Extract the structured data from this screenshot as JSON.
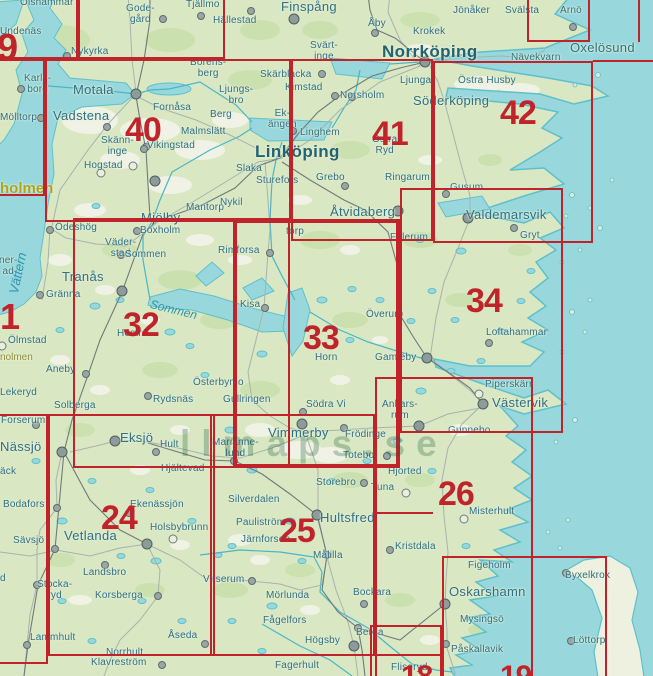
{
  "map_title": "Map sheet index – Östergötland / Småland (sheets 24-26, 32-34, 40-42)",
  "colors": {
    "sea": "#98d8dc",
    "land": "#d9e8c2",
    "sheet_red": "#c1232b",
    "label_teal": "#2f7082",
    "yellow_label": "#b3a314"
  },
  "watermark": {
    "text": "llmaps.se",
    "x": 180,
    "y": 423
  },
  "sheet_numbers": [
    {
      "text": "9",
      "x": -3,
      "y": 29,
      "fs": 38
    },
    {
      "text": "40",
      "x": 125,
      "y": 113
    },
    {
      "text": "41",
      "x": 372,
      "y": 117
    },
    {
      "text": "42",
      "x": 500,
      "y": 96
    },
    {
      "text": "1",
      "x": 0,
      "y": 299,
      "fs": 36
    },
    {
      "text": "32",
      "x": 123,
      "y": 308
    },
    {
      "text": "33",
      "x": 303,
      "y": 321
    },
    {
      "text": "34",
      "x": 466,
      "y": 284
    },
    {
      "text": "24",
      "x": 101,
      "y": 501
    },
    {
      "text": "25",
      "x": 279,
      "y": 514
    },
    {
      "text": "26",
      "x": 438,
      "y": 477
    },
    {
      "text": "18",
      "x": 401,
      "y": 662,
      "fs": 30
    },
    {
      "text": "19",
      "x": 500,
      "y": 662,
      "fs": 30
    }
  ],
  "rects": [
    {
      "x": -30,
      "y": -40,
      "w": 108,
      "h": 99
    },
    {
      "x": 78,
      "y": -40,
      "w": 147,
      "h": 99
    },
    {
      "x": 527,
      "y": -30,
      "w": 63,
      "h": 72
    },
    {
      "x": -60,
      "y": 59,
      "w": 105,
      "h": 137
    },
    {
      "x": 45,
      "y": 59,
      "w": 246,
      "h": 163
    },
    {
      "x": 291,
      "y": 59,
      "w": 142,
      "h": 182
    },
    {
      "x": 433,
      "y": 61,
      "w": 160,
      "h": 182
    },
    {
      "x": 73,
      "y": 218,
      "w": 217,
      "h": 250
    },
    {
      "x": 233,
      "y": 219,
      "w": 167,
      "h": 249,
      "cls": "bold"
    },
    {
      "x": 400,
      "y": 188,
      "w": 163,
      "h": 245
    },
    {
      "x": 375,
      "y": 377,
      "w": 158,
      "h": 320
    },
    {
      "x": 48,
      "y": 414,
      "w": 167,
      "h": 242
    },
    {
      "x": 210,
      "y": 414,
      "w": 165,
      "h": 242
    },
    {
      "x": -60,
      "y": 414,
      "w": 108,
      "h": 250
    },
    {
      "x": 370,
      "y": 625,
      "w": 72,
      "h": 80
    },
    {
      "x": 442,
      "y": 556,
      "w": 165,
      "h": 150
    }
  ],
  "segments": [
    {
      "x": 373,
      "y": 512,
      "w": 60,
      "h": 2
    },
    {
      "x": 375,
      "y": 654,
      "w": 67,
      "h": 2
    },
    {
      "x": 593,
      "y": 60,
      "w": 60,
      "h": 2
    },
    {
      "x": 638,
      "y": 0,
      "w": 2,
      "h": 42
    }
  ],
  "towns": [
    {
      "text": "Olshammar",
      "x": 20,
      "y": -2
    },
    {
      "text": "Undenäs",
      "x": 0,
      "y": 27
    },
    {
      "text": "Gode-\ngård",
      "x": 126,
      "y": 4,
      "cls": "two"
    },
    {
      "text": "Tjällmo",
      "x": 186,
      "y": 0
    },
    {
      "text": "Hällestad",
      "x": 213,
      "y": 16
    },
    {
      "text": "Finspång",
      "x": 281,
      "y": 0,
      "cls": "lg"
    },
    {
      "text": "Jönåker",
      "x": 453,
      "y": 6
    },
    {
      "text": "Svälsta",
      "x": 505,
      "y": 6
    },
    {
      "text": "Arnö",
      "x": 560,
      "y": 6
    },
    {
      "text": "Krokek",
      "x": 413,
      "y": 27
    },
    {
      "text": "Åby",
      "x": 368,
      "y": 19
    },
    {
      "text": "Nykyrka",
      "x": 71,
      "y": 47
    },
    {
      "text": "Norrköping",
      "x": 382,
      "y": 43,
      "cls": "xl"
    },
    {
      "text": "Oxelösund",
      "x": 570,
      "y": 41,
      "cls": "lg"
    },
    {
      "text": "Nävekvarn",
      "x": 511,
      "y": 53
    },
    {
      "text": "Karls-\nborg",
      "x": 24,
      "y": 74,
      "cls": "two"
    },
    {
      "text": "Borens-\nberg",
      "x": 190,
      "y": 58,
      "cls": "two"
    },
    {
      "text": "Svärt-\ninge",
      "x": 310,
      "y": 41,
      "cls": "two"
    },
    {
      "text": "Skärblacka",
      "x": 260,
      "y": 70
    },
    {
      "text": "Kimstad",
      "x": 285,
      "y": 83
    },
    {
      "text": "Norsholm",
      "x": 340,
      "y": 91
    },
    {
      "text": "Ljunga",
      "x": 400,
      "y": 76
    },
    {
      "text": "Östra Husby",
      "x": 458,
      "y": 76
    },
    {
      "text": "Söderköping",
      "x": 413,
      "y": 94,
      "cls": "lg"
    },
    {
      "text": "Mölltorp",
      "x": 0,
      "y": 113
    },
    {
      "text": "Motala",
      "x": 73,
      "y": 83,
      "cls": "lg"
    },
    {
      "text": "Fornåsa",
      "x": 153,
      "y": 103
    },
    {
      "text": "Ljungs-\nbro",
      "x": 219,
      "y": 85,
      "cls": "two"
    },
    {
      "text": "Berg",
      "x": 210,
      "y": 110
    },
    {
      "text": "Ek-\nängen",
      "x": 268,
      "y": 109,
      "cls": "two"
    },
    {
      "text": "Linghem",
      "x": 300,
      "y": 128
    },
    {
      "text": "Malmslätt",
      "x": 181,
      "y": 127
    },
    {
      "text": "Vikingstad",
      "x": 147,
      "y": 141
    },
    {
      "text": "Skänn-\ninge",
      "x": 101,
      "y": 136,
      "cls": "two"
    },
    {
      "text": "Hogstad",
      "x": 84,
      "y": 161
    },
    {
      "text": "Vadstena",
      "x": 53,
      "y": 109,
      "cls": "lg"
    },
    {
      "text": "Linköping",
      "x": 255,
      "y": 143,
      "cls": "xl"
    },
    {
      "text": "Östra\nRyd",
      "x": 372,
      "y": 135,
      "cls": "two"
    },
    {
      "text": "Ringarum",
      "x": 385,
      "y": 173
    },
    {
      "text": "Mjölby",
      "x": 141,
      "y": 211,
      "cls": "lg"
    },
    {
      "text": "Mantorp",
      "x": 186,
      "y": 203
    },
    {
      "text": "Väder-\nstad",
      "x": 105,
      "y": 238,
      "cls": "two"
    },
    {
      "text": "Slaka",
      "x": 236,
      "y": 164
    },
    {
      "text": "Sturefors",
      "x": 256,
      "y": 176
    },
    {
      "text": "Grebo",
      "x": 316,
      "y": 173
    },
    {
      "text": "Nykil",
      "x": 220,
      "y": 198
    },
    {
      "text": "Åtvidaberg",
      "x": 330,
      "y": 205,
      "cls": "lg"
    },
    {
      "text": "Gusum",
      "x": 450,
      "y": 183
    },
    {
      "text": "Valdemarsvik",
      "x": 466,
      "y": 208,
      "cls": "lg"
    },
    {
      "text": "Gryt",
      "x": 520,
      "y": 231
    },
    {
      "text": "Falerum",
      "x": 390,
      "y": 233
    },
    {
      "text": "torp",
      "x": 286,
      "y": 227
    },
    {
      "text": "Ödeshög",
      "x": 55,
      "y": 223
    },
    {
      "text": "Boxholm",
      "x": 140,
      "y": 226
    },
    {
      "text": "Sommen",
      "x": 125,
      "y": 250
    },
    {
      "text": "Tranås",
      "x": 62,
      "y": 270,
      "cls": "lg"
    },
    {
      "text": "Rimforsa",
      "x": 218,
      "y": 246
    },
    {
      "text": "Kisa",
      "x": 240,
      "y": 300
    },
    {
      "text": "Gränna",
      "x": 46,
      "y": 290
    },
    {
      "text": "Ölmstad",
      "x": 8,
      "y": 336
    },
    {
      "text": "Hestra",
      "x": 117,
      "y": 329
    },
    {
      "text": "Överum",
      "x": 366,
      "y": 310
    },
    {
      "text": "Horn",
      "x": 315,
      "y": 353
    },
    {
      "text": "Gamleby",
      "x": 375,
      "y": 353
    },
    {
      "text": "Loftahammar",
      "x": 486,
      "y": 328
    },
    {
      "text": "Piperskärr",
      "x": 485,
      "y": 380
    },
    {
      "text": "Västervik",
      "x": 492,
      "y": 396,
      "cls": "lg"
    },
    {
      "text": "Gunnebo",
      "x": 448,
      "y": 426
    },
    {
      "text": "Ankars-\nrum",
      "x": 382,
      "y": 400,
      "cls": "two"
    },
    {
      "text": "Aneby",
      "x": 46,
      "y": 365
    },
    {
      "text": "Lekeryd",
      "x": 0,
      "y": 388
    },
    {
      "text": "Solberga",
      "x": 54,
      "y": 401
    },
    {
      "text": "Forserum",
      "x": 1,
      "y": 416
    },
    {
      "text": "Nässjö",
      "x": 0,
      "y": 440,
      "cls": "lg"
    },
    {
      "text": "Rydsnäs",
      "x": 153,
      "y": 395
    },
    {
      "text": "Österbymo",
      "x": 193,
      "y": 378
    },
    {
      "text": "Gullringen",
      "x": 223,
      "y": 395
    },
    {
      "text": "Södra Vi",
      "x": 306,
      "y": 400
    },
    {
      "text": "Vimmerby",
      "x": 268,
      "y": 426,
      "cls": "lg"
    },
    {
      "text": "Frödinge",
      "x": 345,
      "y": 430
    },
    {
      "text": "Totebo",
      "x": 343,
      "y": 451
    },
    {
      "text": "Marianne-\nlund",
      "x": 212,
      "y": 438,
      "cls": "two"
    },
    {
      "text": "Hjältevad",
      "x": 161,
      "y": 464
    },
    {
      "text": "Eksjö",
      "x": 120,
      "y": 431,
      "cls": "lg"
    },
    {
      "text": "Hult",
      "x": 160,
      "y": 440
    },
    {
      "text": "Hjorted",
      "x": 388,
      "y": 467
    },
    {
      "text": "Tuna",
      "x": 371,
      "y": 483
    },
    {
      "text": "Storebro",
      "x": 316,
      "y": 478
    },
    {
      "text": "Silverdalen",
      "x": 228,
      "y": 495
    },
    {
      "text": "Bodafors",
      "x": 3,
      "y": 500
    },
    {
      "text": "Ekenässjön",
      "x": 130,
      "y": 500
    },
    {
      "text": "Holsbybrunn",
      "x": 150,
      "y": 523
    },
    {
      "text": "Vetlanda",
      "x": 64,
      "y": 529,
      "cls": "lg"
    },
    {
      "text": "Sävsjö",
      "x": 13,
      "y": 536
    },
    {
      "text": "Landsbro",
      "x": 83,
      "y": 568
    },
    {
      "text": "Stocka-\nryd",
      "x": 37,
      "y": 580,
      "cls": "two"
    },
    {
      "text": "Korsberga",
      "x": 95,
      "y": 591
    },
    {
      "text": "Lammhult",
      "x": 30,
      "y": 633
    },
    {
      "text": "Åseda",
      "x": 168,
      "y": 631
    },
    {
      "text": "Norrhult",
      "x": 106,
      "y": 648
    },
    {
      "text": "Klavreström",
      "x": 91,
      "y": 658
    },
    {
      "text": "Pauliström",
      "x": 236,
      "y": 518
    },
    {
      "text": "Hultsfred",
      "x": 320,
      "y": 511,
      "cls": "lg"
    },
    {
      "text": "Järnforsen",
      "x": 241,
      "y": 535
    },
    {
      "text": "Målilla",
      "x": 313,
      "y": 551
    },
    {
      "text": "Virserum",
      "x": 203,
      "y": 575
    },
    {
      "text": "Mörlunda",
      "x": 266,
      "y": 591
    },
    {
      "text": "Kristdala",
      "x": 395,
      "y": 542
    },
    {
      "text": "Bockara",
      "x": 353,
      "y": 588
    },
    {
      "text": "Fågelfors",
      "x": 263,
      "y": 616
    },
    {
      "text": "Högsby",
      "x": 305,
      "y": 636
    },
    {
      "text": "Berga",
      "x": 356,
      "y": 628
    },
    {
      "text": "Fagerhult",
      "x": 275,
      "y": 661
    },
    {
      "text": "Fliseryd",
      "x": 391,
      "y": 663
    },
    {
      "text": "Misterhult",
      "x": 469,
      "y": 507
    },
    {
      "text": "Figeholm",
      "x": 468,
      "y": 561
    },
    {
      "text": "Oskarshamn",
      "x": 449,
      "y": 585,
      "cls": "lg"
    },
    {
      "text": "Byxelkrok",
      "x": 565,
      "y": 571
    },
    {
      "text": "Mysingsö",
      "x": 460,
      "y": 615
    },
    {
      "text": "Påskallavik",
      "x": 451,
      "y": 645
    },
    {
      "text": "Löttorp",
      "x": 573,
      "y": 636
    }
  ],
  "partials": [
    {
      "text": "ner-\nad",
      "x": -1,
      "y": 256
    },
    {
      "text": "äck",
      "x": 0,
      "y": 467
    },
    {
      "text": "d",
      "x": 0,
      "y": 574
    }
  ],
  "lake_labels": [
    {
      "text": "Vättern",
      "x": 6,
      "y": 292,
      "rot": -78,
      "fs": 13
    },
    {
      "text": "Sommen",
      "x": 152,
      "y": 297,
      "rot": 14,
      "fs": 12
    }
  ],
  "special_labels": [
    {
      "text": "holmen",
      "x": 0,
      "y": 180
    },
    {
      "text": "nolmen",
      "x": 0,
      "y": 352,
      "cls": "sm"
    }
  ],
  "dots": [
    {
      "x": 136,
      "y": 94,
      "cls": "D"
    },
    {
      "x": 67,
      "y": 56
    },
    {
      "x": 21,
      "y": 89
    },
    {
      "x": 41,
      "y": 118
    },
    {
      "x": 163,
      "y": 19
    },
    {
      "x": 201,
      "y": 16
    },
    {
      "x": 251,
      "y": 11
    },
    {
      "x": 294,
      "y": 19,
      "cls": "D"
    },
    {
      "x": 375,
      "y": 33
    },
    {
      "x": 425,
      "y": 62,
      "cls": "D"
    },
    {
      "x": 573,
      "y": 27
    },
    {
      "x": 322,
      "y": 74
    },
    {
      "x": 335,
      "y": 96
    },
    {
      "x": 352,
      "y": 97
    },
    {
      "x": 293,
      "y": 131
    },
    {
      "x": 146,
      "y": 147
    },
    {
      "x": 107,
      "y": 127
    },
    {
      "x": 155,
      "y": 181,
      "cls": "D"
    },
    {
      "x": 137,
      "y": 231
    },
    {
      "x": 121,
      "y": 255
    },
    {
      "x": 122,
      "y": 291,
      "cls": "D"
    },
    {
      "x": 40,
      "y": 295
    },
    {
      "x": 50,
      "y": 230
    },
    {
      "x": 270,
      "y": 253
    },
    {
      "x": 265,
      "y": 308
    },
    {
      "x": 345,
      "y": 186
    },
    {
      "x": 398,
      "y": 211,
      "cls": "D"
    },
    {
      "x": 446,
      "y": 194
    },
    {
      "x": 468,
      "y": 218,
      "cls": "D"
    },
    {
      "x": 514,
      "y": 228
    },
    {
      "x": 399,
      "y": 314
    },
    {
      "x": 427,
      "y": 358,
      "cls": "D"
    },
    {
      "x": 483,
      "y": 404,
      "cls": "D"
    },
    {
      "x": 489,
      "y": 343
    },
    {
      "x": 479,
      "y": 394,
      "cls": "o"
    },
    {
      "x": 86,
      "y": 374
    },
    {
      "x": 36,
      "y": 425
    },
    {
      "x": 62,
      "y": 452,
      "cls": "D"
    },
    {
      "x": 115,
      "y": 441,
      "cls": "D"
    },
    {
      "x": 156,
      "y": 452
    },
    {
      "x": 148,
      "y": 396
    },
    {
      "x": 302,
      "y": 424,
      "cls": "D"
    },
    {
      "x": 303,
      "y": 412
    },
    {
      "x": 344,
      "y": 428
    },
    {
      "x": 387,
      "y": 456
    },
    {
      "x": 364,
      "y": 483
    },
    {
      "x": 234,
      "y": 461
    },
    {
      "x": 317,
      "y": 515,
      "cls": "D"
    },
    {
      "x": 327,
      "y": 555
    },
    {
      "x": 252,
      "y": 581
    },
    {
      "x": 364,
      "y": 604
    },
    {
      "x": 354,
      "y": 646,
      "cls": "D"
    },
    {
      "x": 358,
      "y": 628
    },
    {
      "x": 390,
      "y": 550
    },
    {
      "x": 464,
      "y": 519,
      "cls": "o"
    },
    {
      "x": 445,
      "y": 604,
      "cls": "D"
    },
    {
      "x": 446,
      "y": 644
    },
    {
      "x": 566,
      "y": 573
    },
    {
      "x": 571,
      "y": 641
    },
    {
      "x": 57,
      "y": 508
    },
    {
      "x": 129,
      "y": 513
    },
    {
      "x": 147,
      "y": 544,
      "cls": "D"
    },
    {
      "x": 173,
      "y": 539,
      "cls": "o"
    },
    {
      "x": 55,
      "y": 549
    },
    {
      "x": 105,
      "y": 565
    },
    {
      "x": 37,
      "y": 585
    },
    {
      "x": 158,
      "y": 596
    },
    {
      "x": 27,
      "y": 645
    },
    {
      "x": 205,
      "y": 644
    },
    {
      "x": 162,
      "y": 665
    },
    {
      "x": 419,
      "y": 426,
      "cls": "D"
    },
    {
      "x": 406,
      "y": 493,
      "cls": "o"
    },
    {
      "x": 2,
      "y": 346,
      "cls": "o"
    },
    {
      "x": 101,
      "y": 173,
      "cls": "o"
    },
    {
      "x": 133,
      "y": 166,
      "cls": "o"
    },
    {
      "x": 144,
      "y": 149
    }
  ]
}
